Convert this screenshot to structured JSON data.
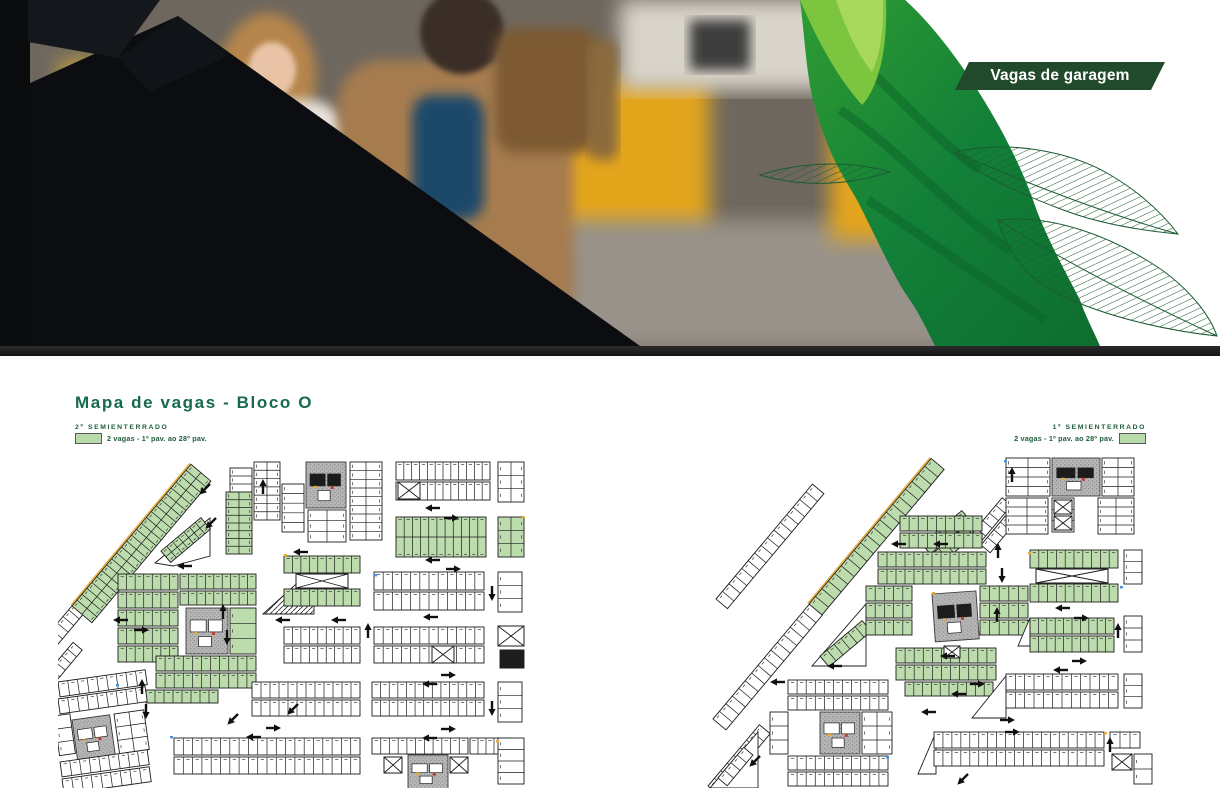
{
  "hero": {
    "banner_label": "Vagas de garagem",
    "photo_alt": "parking-garage-couple-photo",
    "leaf_graphic": "green-leaf-artwork"
  },
  "section": {
    "title": "Mapa de vagas - Bloco O"
  },
  "maps": {
    "left": {
      "floor_label": "2º SEMIENTERRADO",
      "legend_text": "2 vagas - 1º pav. ao 28º pav."
    },
    "right": {
      "floor_label": "1º SEMIENTERRADO",
      "legend_text": "2 vagas - 1º pav. ao 28º pav."
    }
  },
  "colors": {
    "accent_green": "#166a4d",
    "label_green": "#1d5c3a",
    "banner_bg": "#21492b",
    "stall_highlight_green": "#b9dbab",
    "leaf_green_dark": "#117a33",
    "leaf_green_light": "#7cc63f",
    "plan_line": "#1b1b1b",
    "hero_bar": "#1b1b1b"
  }
}
